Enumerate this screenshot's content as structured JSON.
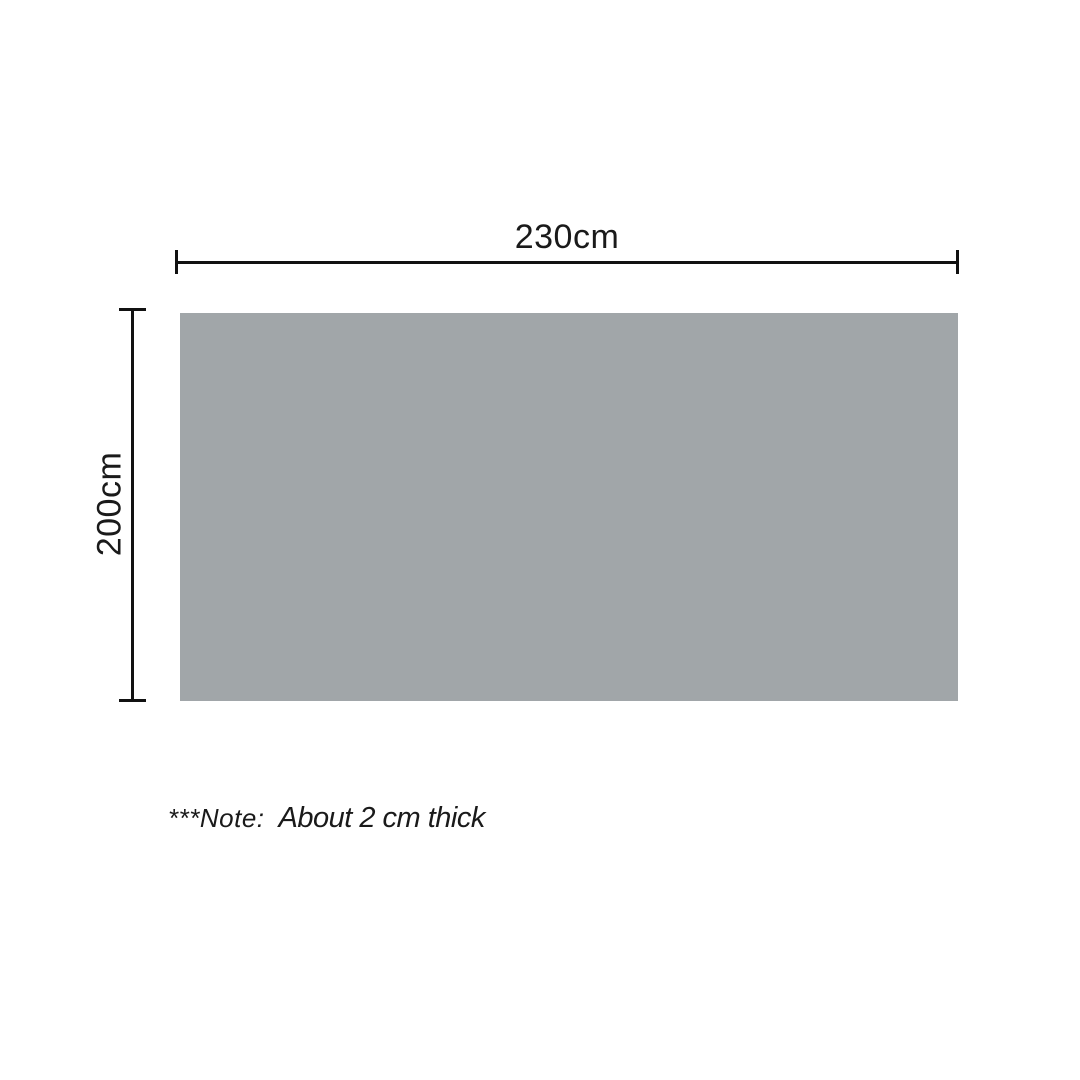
{
  "diagram": {
    "type": "product-dimension-diagram",
    "panel": {
      "shape": "rectangle",
      "color": "#a1a6a9"
    },
    "dimensions": {
      "width_label": "230cm",
      "height_label": "200cm"
    },
    "note": {
      "prefix": "***Note:",
      "text": "About 2 cm thick"
    },
    "colors": {
      "line": "#111111",
      "text": "#1a1a1a",
      "background": "#ffffff"
    }
  }
}
